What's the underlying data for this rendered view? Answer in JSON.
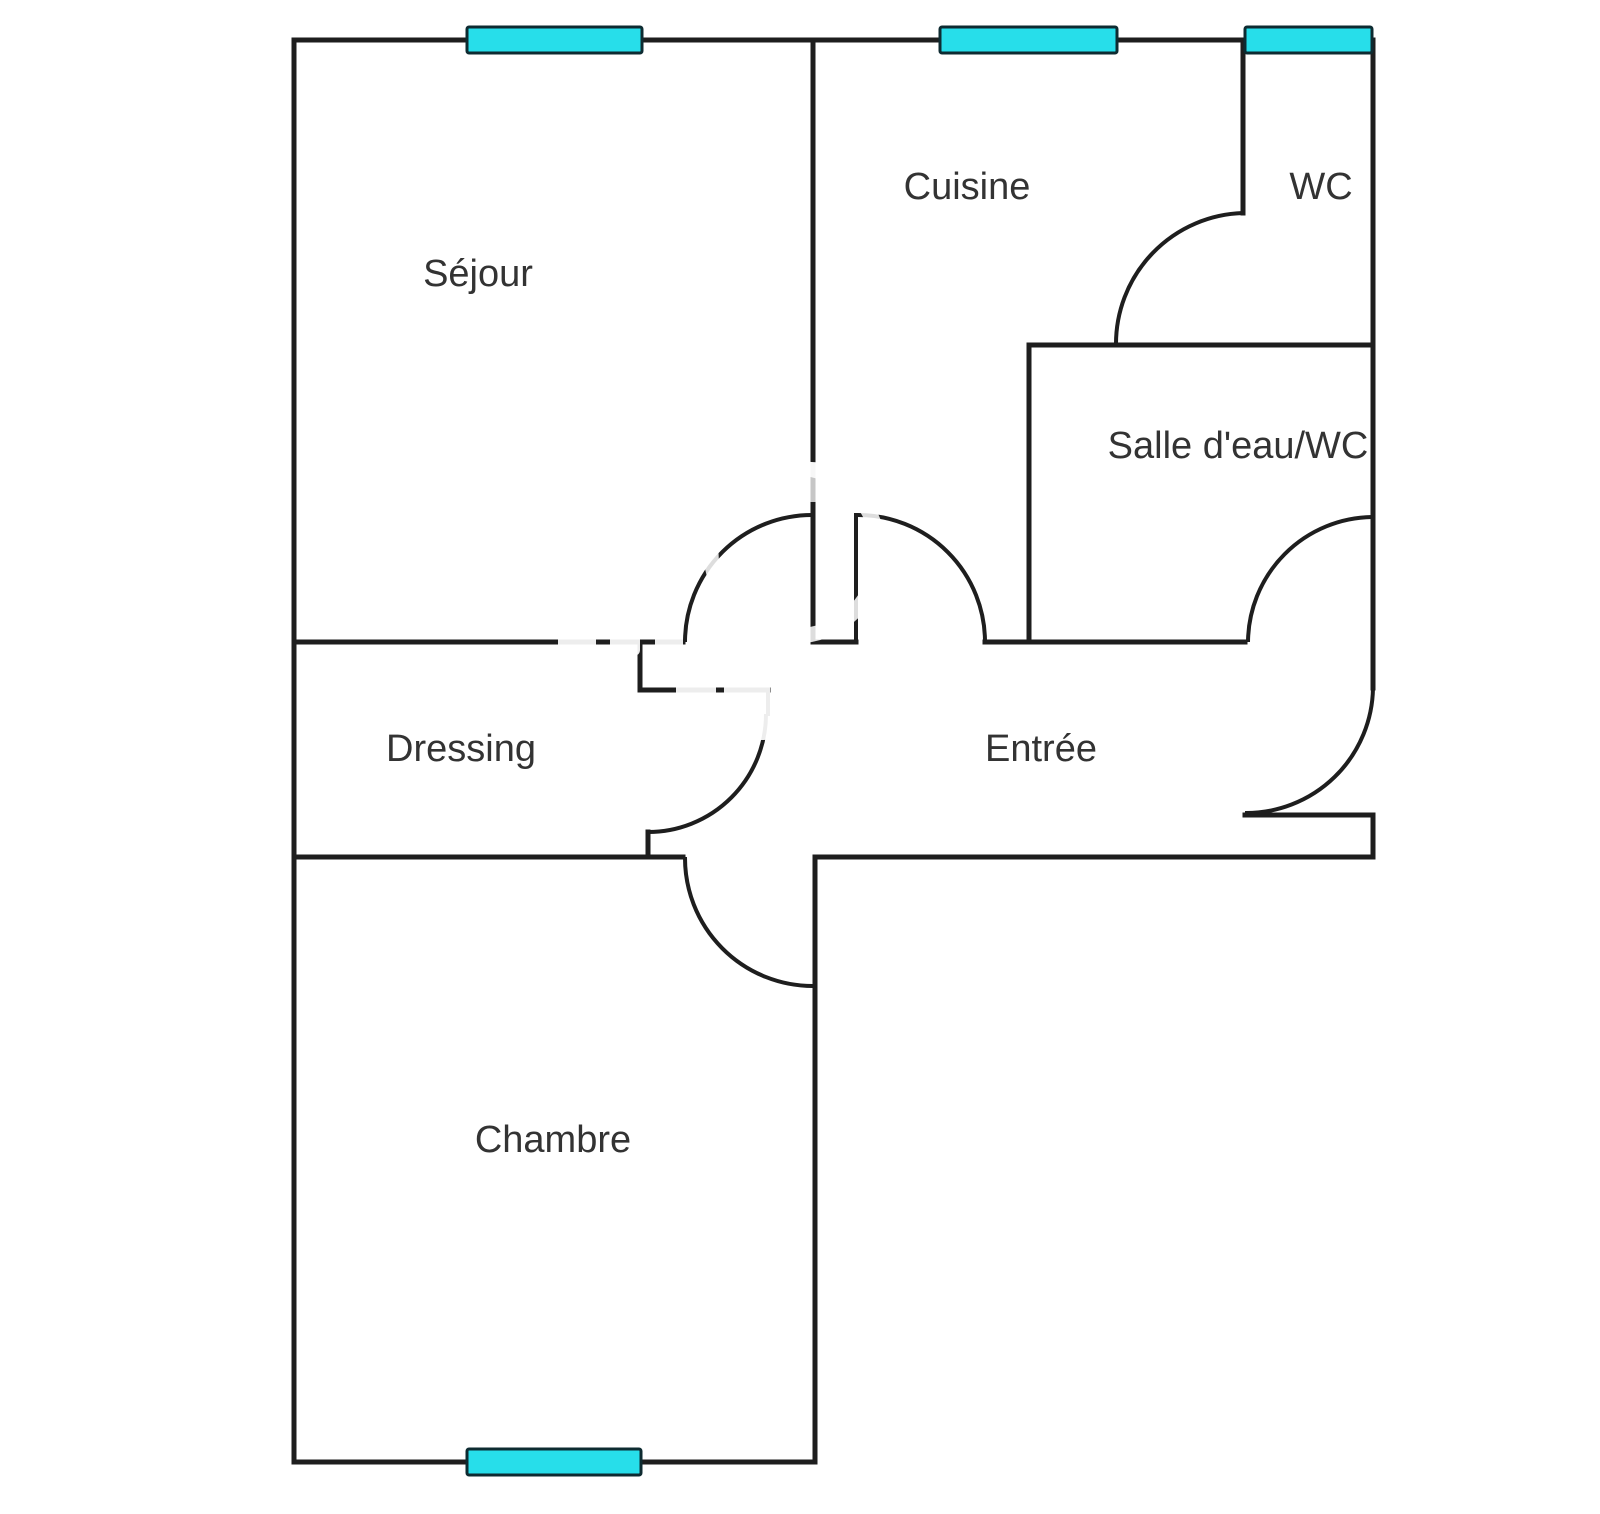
{
  "title": "Apartment floor plan",
  "background": "#ffffff",
  "style": {
    "wall_color": "#1e1e1e",
    "wall_width": 5,
    "leaf_width": 4,
    "door_color": "#1e1e1e",
    "door_width": 4,
    "window_fill": "#27deea",
    "window_border": "#0e2b31",
    "window_border_width": 3,
    "label_color": "#333333",
    "label_font_size": 38,
    "watermark_color": "#ffffff"
  },
  "rooms": [
    {
      "id": "sejour",
      "label": "Séjour",
      "cx": 478,
      "cy": 274
    },
    {
      "id": "cuisine",
      "label": "Cuisine",
      "cx": 967,
      "cy": 187
    },
    {
      "id": "wc",
      "label": "WC",
      "cx": 1321,
      "cy": 187
    },
    {
      "id": "salle-deau-wc",
      "label": "Salle d'eau/WC",
      "cx": 1238,
      "cy": 446
    },
    {
      "id": "dressing",
      "label": "Dressing",
      "cx": 461,
      "cy": 749
    },
    {
      "id": "entree",
      "label": "Entrée",
      "cx": 1041,
      "cy": 749
    },
    {
      "id": "chambre",
      "label": "Chambre",
      "cx": 553,
      "cy": 1140
    }
  ],
  "walls": [
    {
      "id": "outer-top",
      "x1": 294,
      "y1": 40,
      "x2": 1373,
      "y2": 40,
      "kind": "wall"
    },
    {
      "id": "outer-left",
      "x1": 294,
      "y1": 40,
      "x2": 294,
      "y2": 1462,
      "kind": "wall"
    },
    {
      "id": "outer-bottom",
      "x1": 294,
      "y1": 1462,
      "x2": 815,
      "y2": 1462,
      "kind": "wall"
    },
    {
      "id": "outer-right-upper",
      "x1": 1373,
      "y1": 40,
      "x2": 1373,
      "y2": 688,
      "kind": "wall"
    },
    {
      "id": "entry-notch-top",
      "x1": 1245,
      "y1": 815,
      "x2": 1373,
      "y2": 815,
      "kind": "wall"
    },
    {
      "id": "outer-right-lower",
      "x1": 1373,
      "y1": 815,
      "x2": 1373,
      "y2": 857,
      "kind": "wall"
    },
    {
      "id": "entree-bottom",
      "x1": 815,
      "y1": 857,
      "x2": 1373,
      "y2": 857,
      "kind": "wall"
    },
    {
      "id": "dressing-bottom",
      "x1": 294,
      "y1": 857,
      "x2": 683,
      "y2": 857,
      "kind": "wall"
    },
    {
      "id": "chambre-right",
      "x1": 815,
      "y1": 857,
      "x2": 815,
      "y2": 1462,
      "kind": "wall"
    },
    {
      "id": "sejour-cuisine",
      "x1": 813,
      "y1": 40,
      "x2": 813,
      "y2": 642,
      "kind": "wall"
    },
    {
      "id": "mid-left",
      "x1": 294,
      "y1": 642,
      "x2": 683,
      "y2": 642,
      "kind": "wall"
    },
    {
      "id": "mid-stub",
      "x1": 813,
      "y1": 642,
      "x2": 856,
      "y2": 642,
      "kind": "wall"
    },
    {
      "id": "entree-door-leaf",
      "x1": 856,
      "y1": 515,
      "x2": 856,
      "y2": 642,
      "kind": "leaf"
    },
    {
      "id": "mid-right",
      "x1": 985,
      "y1": 642,
      "x2": 1245,
      "y2": 642,
      "kind": "wall"
    },
    {
      "id": "salledeau-left",
      "x1": 1029,
      "y1": 345,
      "x2": 1029,
      "y2": 642,
      "kind": "wall"
    },
    {
      "id": "salledeau-top",
      "x1": 1029,
      "y1": 345,
      "x2": 1373,
      "y2": 345,
      "kind": "wall"
    },
    {
      "id": "wc-left",
      "x1": 1243,
      "y1": 40,
      "x2": 1243,
      "y2": 213,
      "kind": "wall"
    },
    {
      "id": "dressing-jamb-v",
      "x1": 640,
      "y1": 642,
      "x2": 640,
      "y2": 690,
      "kind": "wall"
    },
    {
      "id": "dressing-jamb-h",
      "x1": 640,
      "y1": 690,
      "x2": 768,
      "y2": 690,
      "kind": "wall"
    },
    {
      "id": "dressing-door-leaf",
      "x1": 768,
      "y1": 690,
      "x2": 768,
      "y2": 714,
      "kind": "leaf"
    },
    {
      "id": "dressing-stub",
      "x1": 648,
      "y1": 832,
      "x2": 648,
      "y2": 857,
      "kind": "wall"
    }
  ],
  "doors": [
    {
      "id": "sejour-door-arc",
      "x1": 813,
      "y1": 515,
      "x2": 685,
      "y2": 642,
      "r": 127,
      "sweep": 0
    },
    {
      "id": "entree-door-arc",
      "x1": 858,
      "y1": 515,
      "x2": 985,
      "y2": 642,
      "r": 127,
      "sweep": 1
    },
    {
      "id": "wc-door-arc",
      "x1": 1243,
      "y1": 213,
      "x2": 1116,
      "y2": 345,
      "r": 131,
      "sweep": 0
    },
    {
      "id": "salledeau-door-arc",
      "x1": 1372,
      "y1": 517,
      "x2": 1248,
      "y2": 642,
      "r": 126,
      "sweep": 0
    },
    {
      "id": "front-door-arc",
      "x1": 1373,
      "y1": 688,
      "x2": 1245,
      "y2": 813,
      "r": 127,
      "sweep": 1
    },
    {
      "id": "dressing-door-arc",
      "x1": 766,
      "y1": 714,
      "x2": 648,
      "y2": 832,
      "r": 118,
      "sweep": 1
    },
    {
      "id": "chambre-door-arc",
      "x1": 685,
      "y1": 857,
      "x2": 813,
      "y2": 986,
      "r": 128,
      "sweep": 0
    }
  ],
  "windows": [
    {
      "id": "window-sejour",
      "x": 467,
      "y": 27,
      "w": 175,
      "h": 26
    },
    {
      "id": "window-cuisine",
      "x": 940,
      "y": 27,
      "w": 177,
      "h": 26
    },
    {
      "id": "window-wc",
      "x": 1245,
      "y": 27,
      "w": 127,
      "h": 26
    },
    {
      "id": "window-chambre",
      "x": 467,
      "y": 1449,
      "w": 174,
      "h": 26
    }
  ],
  "watermark": {
    "ring": {
      "cx": 795,
      "cy": 552,
      "r": 84,
      "stroke_width": 15,
      "opacity": 0.85
    },
    "patches": [
      {
        "x": 558,
        "y": 620,
        "w": 38,
        "h": 36,
        "opacity": 0.92
      },
      {
        "x": 610,
        "y": 616,
        "w": 30,
        "h": 40,
        "opacity": 0.92
      },
      {
        "x": 655,
        "y": 612,
        "w": 28,
        "h": 44,
        "opacity": 0.92
      },
      {
        "x": 676,
        "y": 678,
        "w": 40,
        "h": 62,
        "opacity": 0.92
      },
      {
        "x": 724,
        "y": 682,
        "w": 46,
        "h": 58,
        "opacity": 0.92
      },
      {
        "x": 805,
        "y": 462,
        "w": 16,
        "h": 40,
        "opacity": 0.75
      }
    ]
  }
}
